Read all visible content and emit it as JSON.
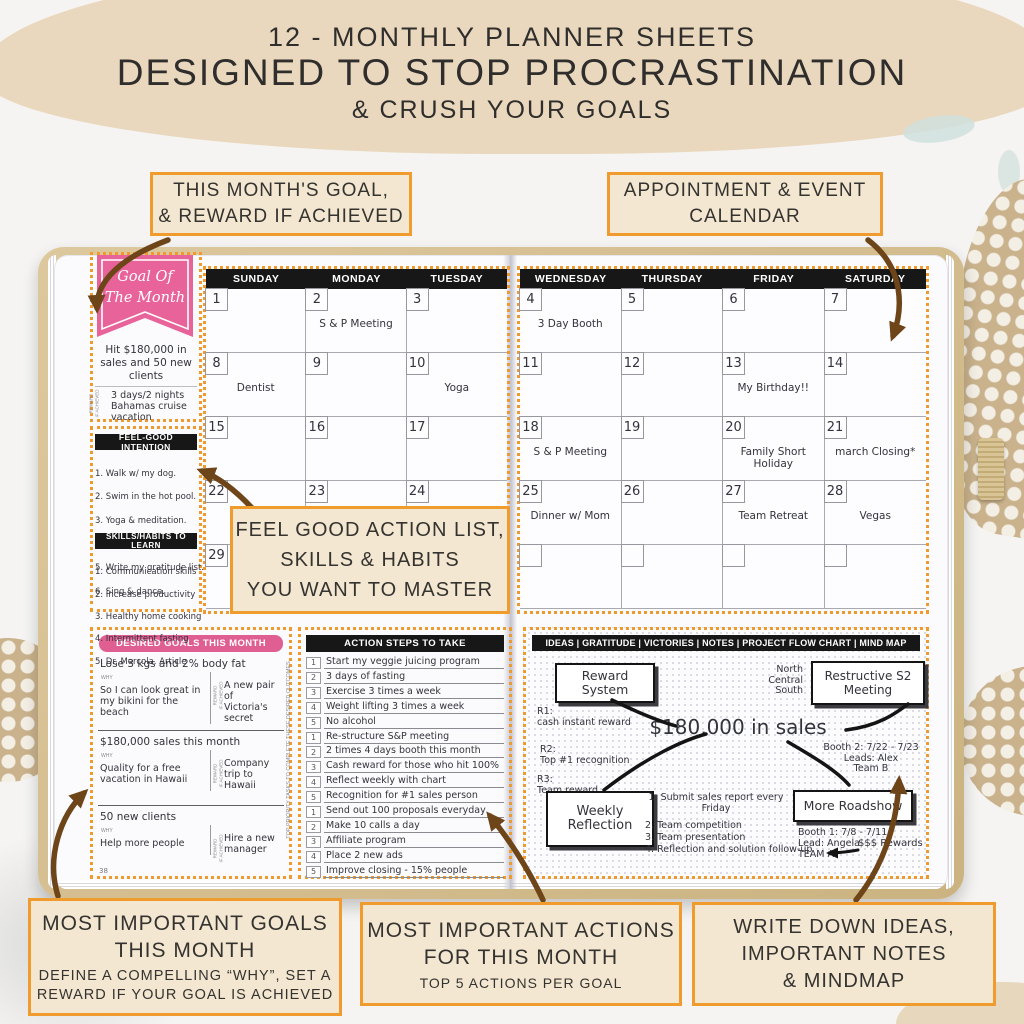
{
  "header": {
    "line1": "12 - MONTHLY PLANNER SHEETS",
    "line2": "DESIGNED TO STOP PROCRASTINATION",
    "line3": "& CRUSH YOUR GOALS"
  },
  "callouts": {
    "top_left": "THIS MONTH'S GOAL,\n& REWARD IF ACHIEVED",
    "top_right": "APPOINTMENT & EVENT\nCALENDAR",
    "mid_center": "FEEL GOOD ACTION LIST,\nSKILLS & HABITS\nYOU WANT TO MASTER",
    "bottom_left_title": "MOST IMPORTANT GOALS\nTHIS MONTH",
    "bottom_left_sub": "DEFINE A COMPELLING “WHY”, SET A\nREWARD IF YOUR GOAL IS ACHIEVED",
    "bottom_mid_title": "MOST IMPORTANT ACTIONS\nFOR THIS MONTH",
    "bottom_mid_sub": "TOP 5 ACTIONS PER GOAL",
    "bottom_right_title": "WRITE DOWN IDEAS,\nIMPORTANT NOTES\n& MINDMAP"
  },
  "goal_month": {
    "banner": "Goal Of\nThe Month",
    "goal_text": "Hit $180,000 in\nsales and 50 new\nclients",
    "reward_side_label": "REWARD\nIF ACHIEVED",
    "reward_text": "3 days/2 nights\nBahamas cruise\nvacation"
  },
  "feel_good": {
    "title": "FEEL-GOOD INTENTION",
    "items": [
      "1. Walk w/ my dog.",
      "2. Swim in the hot pool.",
      "3. Yoga & meditation.",
      "4. Send love",
      "5. Write my gratitude list.",
      "6. Sing & dance."
    ]
  },
  "skills": {
    "title": "SKILLS/HABITS TO LEARN",
    "items": [
      "1. Communication skills",
      "2. Increase productivity",
      "3. Healthy home cooking",
      "4. Intermittent fasting",
      "5. Dr. Mercola. Article"
    ]
  },
  "calendar_left": {
    "days": [
      "SUNDAY",
      "MONDAY",
      "TUESDAY"
    ],
    "cells": [
      {
        "n": "1",
        "e": ""
      },
      {
        "n": "2",
        "e": "S & P Meeting"
      },
      {
        "n": "3",
        "e": ""
      },
      {
        "n": "8",
        "e": "Dentist"
      },
      {
        "n": "9",
        "e": ""
      },
      {
        "n": "10",
        "e": "Yoga"
      },
      {
        "n": "15",
        "e": ""
      },
      {
        "n": "16",
        "e": ""
      },
      {
        "n": "17",
        "e": ""
      },
      {
        "n": "22",
        "e": ""
      },
      {
        "n": "23",
        "e": ""
      },
      {
        "n": "24",
        "e": ""
      },
      {
        "n": "29",
        "e": ""
      },
      {
        "n": "",
        "e": ""
      },
      {
        "n": "",
        "e": ""
      }
    ]
  },
  "calendar_right": {
    "days": [
      "WEDNESDAY",
      "THURSDAY",
      "FRIDAY",
      "SATURDAY"
    ],
    "cells": [
      {
        "n": "4",
        "e": "3 Day Booth"
      },
      {
        "n": "5",
        "e": ""
      },
      {
        "n": "6",
        "e": ""
      },
      {
        "n": "7",
        "e": ""
      },
      {
        "n": "11",
        "e": ""
      },
      {
        "n": "12",
        "e": ""
      },
      {
        "n": "13",
        "e": "My Birthday!!"
      },
      {
        "n": "14",
        "e": ""
      },
      {
        "n": "18",
        "e": "S & P Meeting"
      },
      {
        "n": "19",
        "e": ""
      },
      {
        "n": "20",
        "e": "Family Short\nHoliday"
      },
      {
        "n": "21",
        "e": "march Closing*"
      },
      {
        "n": "25",
        "e": "Dinner w/ Mom"
      },
      {
        "n": "26",
        "e": ""
      },
      {
        "n": "27",
        "e": "Team Retreat"
      },
      {
        "n": "28",
        "e": "Vegas"
      },
      {
        "n": "",
        "e": ""
      },
      {
        "n": "",
        "e": ""
      },
      {
        "n": "",
        "e": ""
      },
      {
        "n": "",
        "e": ""
      }
    ]
  },
  "desired_goals": {
    "title": "DESIRED GOALS THIS MONTH",
    "why_label": "WHY",
    "reward_label": "REWARD\nIF ACHIEVED",
    "items": [
      {
        "goal": "Lose 3 kgs and 2% body fat",
        "why": "So I can look great in\nmy bikini for the beach",
        "reward": "A new pair of\nVictoria's secret"
      },
      {
        "goal": "$180,000 sales this month",
        "why": "Quality for a free\nvacation in Hawaii",
        "reward": "Company trip to\nHawaii"
      },
      {
        "goal": "50 new clients",
        "why": "Help more people",
        "reward": "Hire a new\nmanager"
      }
    ],
    "page_number": "38"
  },
  "action_steps": {
    "title": "ACTION STEPS TO TAKE",
    "side_label": "TOP PRIORITY TASKS TO COMPLETE THESE DESIRED OUTCOMES",
    "items": [
      {
        "n": "1",
        "t": "Start my veggie juicing program"
      },
      {
        "n": "2",
        "t": "3 days of fasting"
      },
      {
        "n": "3",
        "t": "Exercise 3 times a week"
      },
      {
        "n": "4",
        "t": "Weight lifting 3 times a week"
      },
      {
        "n": "5",
        "t": "No alcohol"
      },
      {
        "n": "1",
        "t": "Re-structure S&P meeting"
      },
      {
        "n": "2",
        "t": "2 times 4 days booth this month"
      },
      {
        "n": "3",
        "t": "Cash reward for those who hit 100%"
      },
      {
        "n": "4",
        "t": "Reflect weekly with chart"
      },
      {
        "n": "5",
        "t": "Recognition for #1 sales person"
      },
      {
        "n": "1",
        "t": "Send out 100 proposals everyday"
      },
      {
        "n": "2",
        "t": "Make 10 calls a day"
      },
      {
        "n": "3",
        "t": "Affiliate program"
      },
      {
        "n": "4",
        "t": "Place 2 new ads"
      },
      {
        "n": "5",
        "t": "Improve closing - 15% people"
      }
    ]
  },
  "mindmap": {
    "header": "IDEAS  |  GRATITUDE  |  VICTORIES  |  NOTES  |  PROJECT FLOW CHART  |  MIND MAP",
    "center": "$180,000 in sales",
    "box_reward": "Reward\nSystem",
    "box_restructive": "Restructive S2\nMeeting",
    "box_weekly": "Weekly\nReflection",
    "box_roadshow": "More Roadshow",
    "note_north": "North\nCentral\nSouth",
    "note_r1": "R1:\ncash instant reward",
    "note_r2": "R2:\nTop #1 recognition",
    "note_r3": "R3:\nTeam reward",
    "note_booth2": "Booth 2: 7/22 - 7/23\nLeads: Alex\nTeam B",
    "note_plan1": "1. Submit sales report every\nFriday",
    "note_plan_rest": "2. Team competition\n3. Team presentation\n4. Reflection and solution follow-up",
    "note_booth1": "Booth 1: 7/8 - 7/11\nLead: Angela\nTEAM A",
    "note_rewards": "$$$ Rewards"
  },
  "colors": {
    "accent_orange": "#EF9B2D",
    "pink_banner": "#E8639A",
    "pink_bar": "#E05F92",
    "arrow_brown": "#6E4419",
    "black_bar": "#171717",
    "callout_bg": "#F4E7D2",
    "cover_tan": "#D5C091"
  }
}
